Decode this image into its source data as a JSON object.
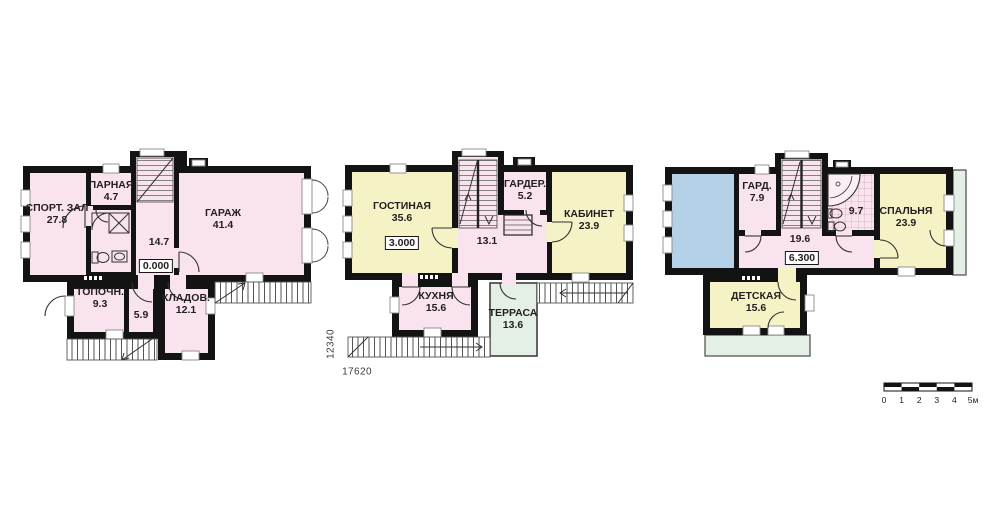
{
  "page": {
    "background": "#ffffff"
  },
  "colors": {
    "wall": "#131313",
    "room_pink": "#f9e3ee",
    "room_yellow": "#f5f2c6",
    "terrace_green": "#e4efe5",
    "void_blue": "#b4d1e8"
  },
  "plans": [
    {
      "id": "ground-floor",
      "elevation": "0.000",
      "rooms": [
        {
          "name": "СПОРТ. ЗАЛ",
          "area": "27.8"
        },
        {
          "name": "ПАРНАЯ",
          "area": "4.7"
        },
        {
          "name": "",
          "area": "14.7"
        },
        {
          "name": "ГАРАЖ",
          "area": "41.4"
        },
        {
          "name": "ТОПОЧН.",
          "area": "9.3"
        },
        {
          "name": "",
          "area": "5.9"
        },
        {
          "name": "КЛАДОВ.",
          "area": "12.1"
        }
      ]
    },
    {
      "id": "first-floor",
      "elevation": "3.000",
      "rooms": [
        {
          "name": "ГОСТИНАЯ",
          "area": "35.6"
        },
        {
          "name": "ГАРДЕР.",
          "area": "5.2"
        },
        {
          "name": "КАБИНЕТ",
          "area": "23.9"
        },
        {
          "name": "",
          "area": "13.1"
        },
        {
          "name": "КУХНЯ",
          "area": "15.6"
        },
        {
          "name": "ТЕРРАСА",
          "area": "13.6"
        }
      ]
    },
    {
      "id": "second-floor",
      "elevation": "6.300",
      "rooms": [
        {
          "name": "ГАРД.",
          "area": "7.9"
        },
        {
          "name": "",
          "area": "9.7"
        },
        {
          "name": "СПАЛЬНЯ",
          "area": "23.9"
        },
        {
          "name": "",
          "area": "19.6"
        },
        {
          "name": "ДЕТСКАЯ",
          "area": "15.6"
        }
      ]
    }
  ],
  "dimensions": {
    "vertical": "12340",
    "horizontal": "17620"
  },
  "scale_bar": {
    "ticks": [
      "0",
      "1",
      "2",
      "3",
      "4",
      "5м"
    ]
  },
  "legend_icons": [
    "car-icon",
    "bathtub-icon",
    "shower-icon",
    "toilet-icon",
    "sink-icon",
    "stairs-icon"
  ]
}
